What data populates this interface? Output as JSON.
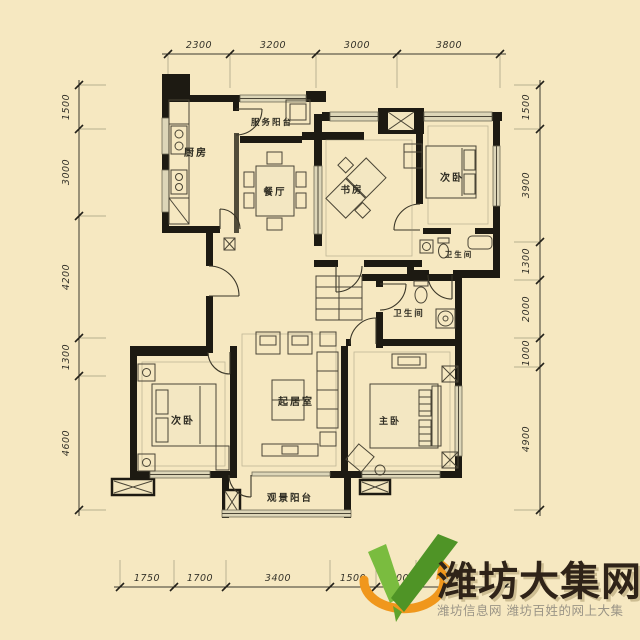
{
  "page": {
    "background": "#f6e8c1"
  },
  "plan": {
    "dims": {
      "top": [
        "2300",
        "3200",
        "3000",
        "3800"
      ],
      "left": [
        "1500",
        "3000",
        "4200",
        "1300",
        "4600"
      ],
      "right": [
        "1500",
        "3900",
        "1300",
        "2000",
        "1000",
        "4900"
      ],
      "bottom": [
        "1750",
        "1700",
        "3400",
        "1500",
        "1300",
        "2900"
      ]
    },
    "rooms": {
      "kitchen": "厨房",
      "service_balcony": "服务阳台",
      "dining": "餐厅",
      "study": "书房",
      "bedroom_top": "次卧",
      "bath_top": "卫生间",
      "bath_mid": "卫生间",
      "living": "起居室",
      "bedroom_left": "次卧",
      "master": "主卧",
      "view_balcony": "观景阳台"
    },
    "colors": {
      "background": "#f6e8c1",
      "wall": "#1d1a12",
      "furniture_line": "#4a4536",
      "window": "#ddd6b8",
      "dim_text": "#35332a"
    }
  },
  "watermark": {
    "site_name": "潍坊大集网",
    "tagline": "潍坊信息网 潍坊百姓的网上大集",
    "colors": {
      "title": "#2f2318",
      "title_shadow": "#cdbd92",
      "tagline": "#9a9486",
      "logo_green_light": "#7abc3f",
      "logo_green_dark": "#4f9426",
      "logo_orange": "#f0971c"
    }
  }
}
